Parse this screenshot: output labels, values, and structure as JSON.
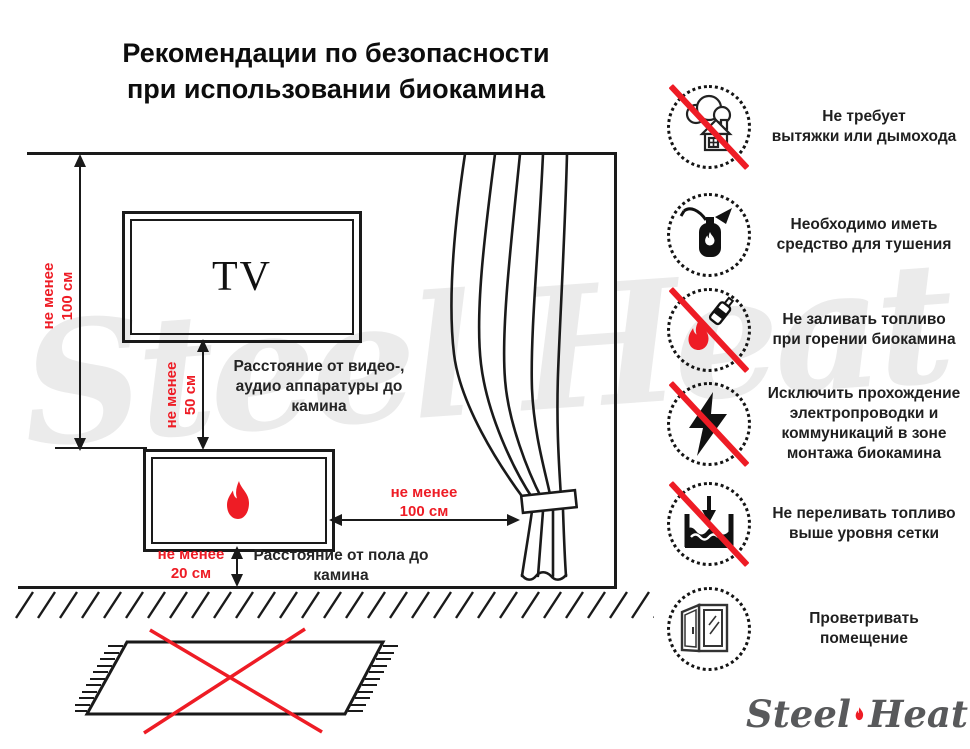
{
  "title": "Рекомендации по безопасности\nпри использовании биокамина",
  "diagram": {
    "tv_label": "TV",
    "dims": {
      "wall_to_fireplace": "не менее\n100 см",
      "tv_to_fireplace": "не менее\n50 см",
      "fireplace_to_curtain": "не менее\n100 см",
      "floor_to_fireplace": "не менее\n20 см"
    },
    "notes": {
      "av_distance": "Расстояние от видео-,\nаудио аппаратуры до\nкамина",
      "floor_distance": "Расстояние от пола до\nкамина"
    },
    "watermark": "Steel Heat"
  },
  "rules": [
    {
      "icon": "no-chimney-icon",
      "crossed": true,
      "label": "Не требует\nвытяжки или дымохода"
    },
    {
      "icon": "extinguisher-icon",
      "crossed": false,
      "label": "Необходимо иметь\nсредство для тушения"
    },
    {
      "icon": "no-refuel-while-burning-icon",
      "crossed": true,
      "label": "Не заливать топливо\nпри горении биокамина"
    },
    {
      "icon": "no-electrical-wiring-icon",
      "crossed": true,
      "label": "Исключить прохождение\nэлектропроводки и\nкоммуникаций в зоне\nмонтажа биокамина"
    },
    {
      "icon": "no-overfill-icon",
      "crossed": true,
      "label": "Не переливать топливо\nвыше уровня сетки"
    },
    {
      "icon": "ventilate-room-icon",
      "crossed": false,
      "label": "Проветривать\nпомещение"
    }
  ],
  "logo": {
    "steel": "Steel",
    "heat": "Heat"
  },
  "colors": {
    "accent_red": "#EE1C25",
    "line_black": "#1A1A1A",
    "watermark_gray": "#EBEBEB",
    "logo_gray": "#58595B"
  }
}
